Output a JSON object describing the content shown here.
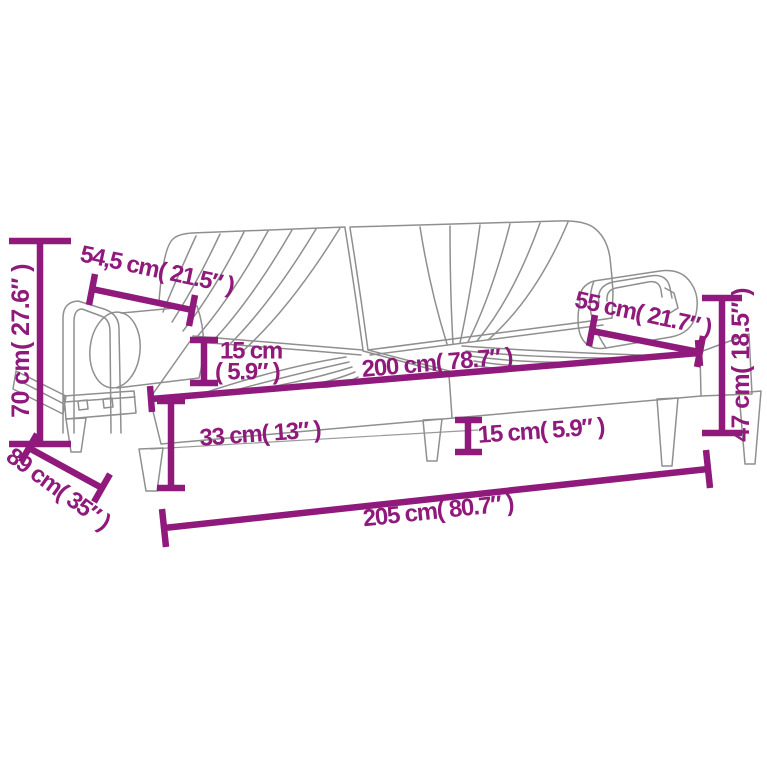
{
  "diagram": {
    "type": "product-dimension-diagram",
    "subject": "sofa-bed-with-armrests-line-drawing",
    "colors": {
      "dimension_accent": "#901A7C",
      "line_art": "#8f8f8f",
      "background": "#ffffff"
    },
    "dimensions": {
      "total_height": "70 cm( 27.6″ )",
      "armrest_left_length": "54,5 cm( 21.5″ )",
      "cushion_thickness_line1": "15 cm",
      "cushion_thickness_line2": "( 5.9″ )",
      "seat_width": "200 cm( 78.7″ )",
      "armrest_right_length": "55 cm( 21.7″ )",
      "right_height": "47 cm( 18.5″ )",
      "seat_height": "33 cm( 13″ )",
      "leg_height": "15 cm( 5.9″ )",
      "depth": "89 cm( 35″ )",
      "total_width": "205 cm( 80.7″ )"
    }
  }
}
